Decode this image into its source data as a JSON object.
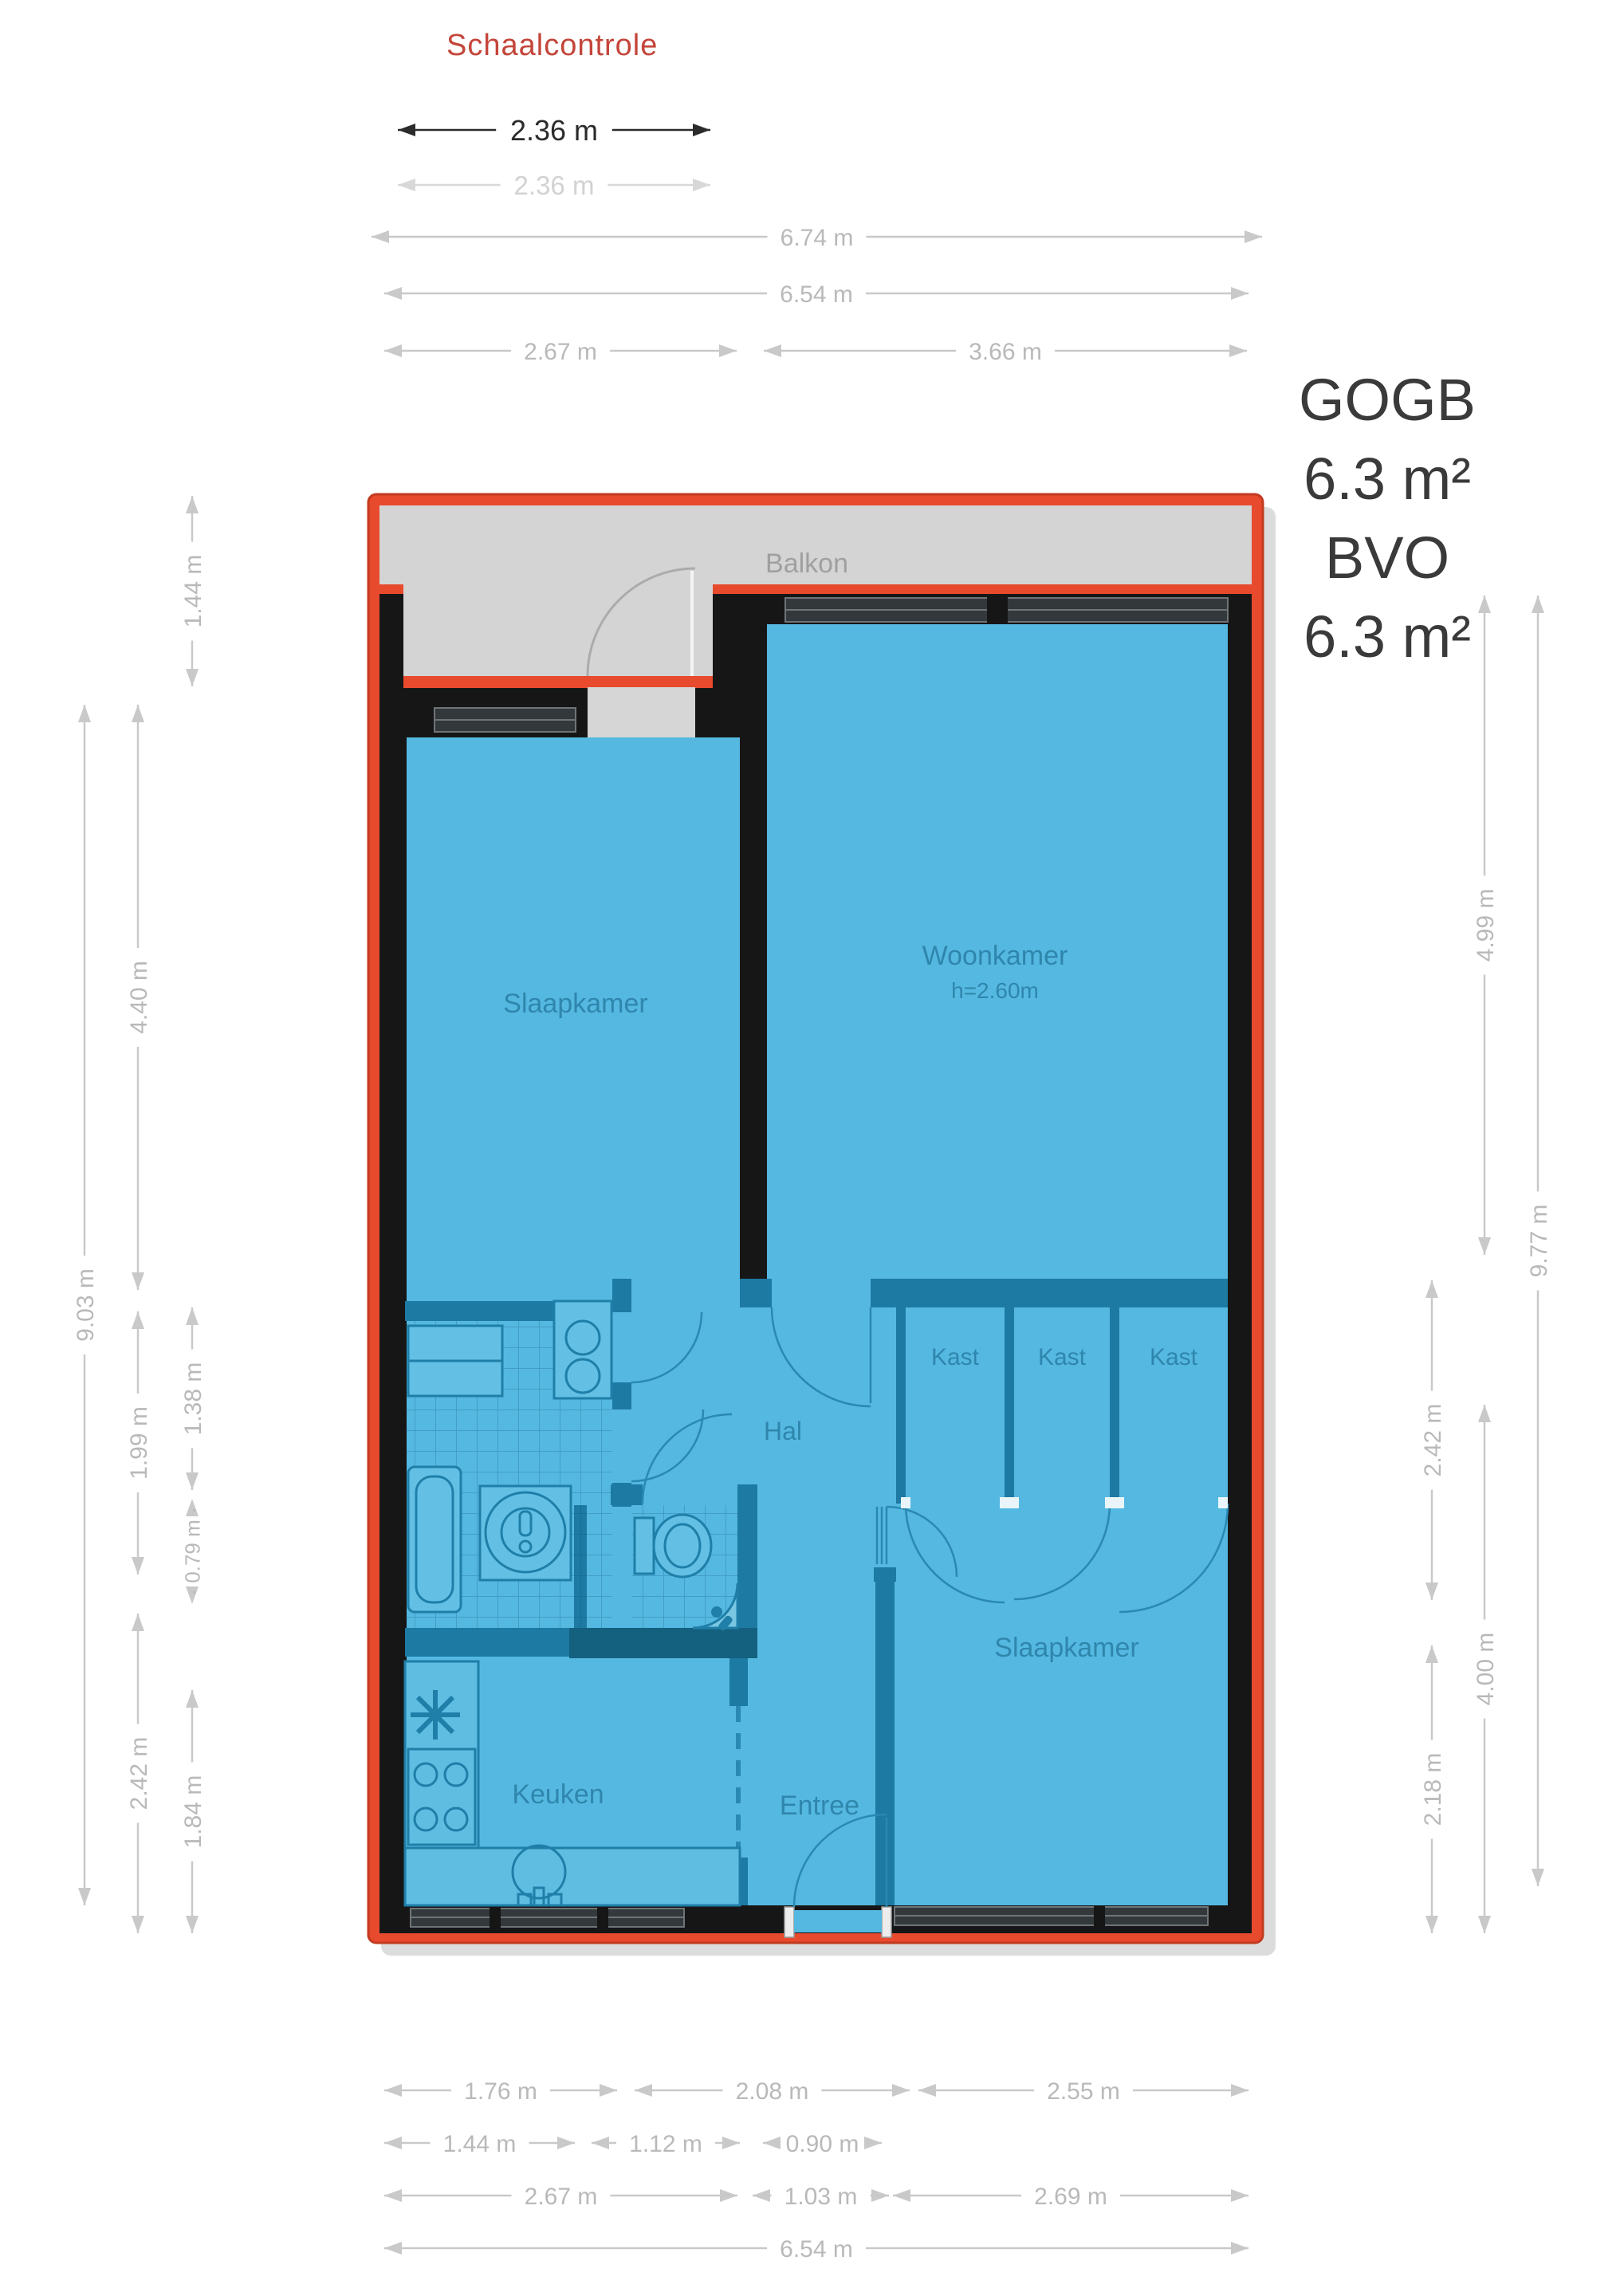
{
  "scale_title": "Schaalcontrole",
  "gogb": {
    "l1": "GOGB",
    "l2": "6.3 m²",
    "l3": "BVO",
    "l4": "6.3 m²"
  },
  "go_overlay": {
    "l1": "GO",
    "l2": "61.9 m²",
    "l3": "BVO",
    "l4": "67.9 m²",
    "height": "h=2,60m"
  },
  "rooms": {
    "balkon": "Balkon",
    "woonkamer": "Woonkamer",
    "woonkamer_height": "h=2.60m",
    "slaapkamer_left": "Slaapkamer",
    "kast1": "Kast",
    "kast2": "Kast",
    "kast3": "Kast",
    "hal": "Hal",
    "slaapkamer_right": "Slaapkamer",
    "keuken": "Keuken",
    "entree": "Entree"
  },
  "dimensions": {
    "scale_check": [
      {
        "id": "s236",
        "label": "2.36 m"
      },
      {
        "id": "g236",
        "label": "2.36 m"
      }
    ],
    "top": [
      {
        "id": "t674",
        "label": "6.74 m"
      },
      {
        "id": "t654",
        "label": "6.54 m"
      },
      {
        "id": "t267",
        "label": "2.67 m"
      },
      {
        "id": "t366",
        "label": "3.66 m"
      }
    ],
    "left": [
      {
        "id": "l903",
        "label": "9.03 m"
      },
      {
        "id": "l440",
        "label": "4.40 m"
      },
      {
        "id": "l199",
        "label": "1.99 m"
      },
      {
        "id": "l242",
        "label": "2.42 m"
      },
      {
        "id": "l144",
        "label": "1.44 m"
      },
      {
        "id": "l138",
        "label": "1.38 m"
      },
      {
        "id": "l079",
        "label": "· 0.79 m ·"
      },
      {
        "id": "l184",
        "label": "1.84 m"
      }
    ],
    "right": [
      {
        "id": "r499",
        "label": "4.99 m"
      },
      {
        "id": "r977",
        "label": "9.77 m"
      },
      {
        "id": "r242",
        "label": "2.42 m"
      },
      {
        "id": "r400",
        "label": "4.00 m"
      },
      {
        "id": "r218",
        "label": "2.18 m"
      }
    ],
    "bottom": [
      {
        "id": "b176",
        "label": "1.76 m"
      },
      {
        "id": "b208",
        "label": "2.08 m"
      },
      {
        "id": "b255",
        "label": "2.55 m"
      },
      {
        "id": "b144",
        "label": "1.44 m"
      },
      {
        "id": "b112",
        "label": "1.12 m"
      },
      {
        "id": "b090",
        "label": "0.90 m"
      },
      {
        "id": "b267",
        "label": "2.67 m"
      },
      {
        "id": "b103",
        "label": "1.03 m"
      },
      {
        "id": "b269",
        "label": "2.69 m"
      },
      {
        "id": "b654",
        "label": "6.54 m"
      }
    ]
  },
  "colors": {
    "outline_red": "#e84a2e",
    "outline_red_dark": "#c23a1f",
    "room_blue": "#55b8e0",
    "wall_black": "#161616",
    "interior_wall_teal": "#1d7aa3",
    "interior_wall_dark": "#14607f",
    "balkon_gray": "#d4d4d4",
    "dimension_gray": "#c9c9c9",
    "text_dark": "#3a3a3a",
    "title_red": "#c4453a",
    "label_blue": "#2f86ad"
  }
}
